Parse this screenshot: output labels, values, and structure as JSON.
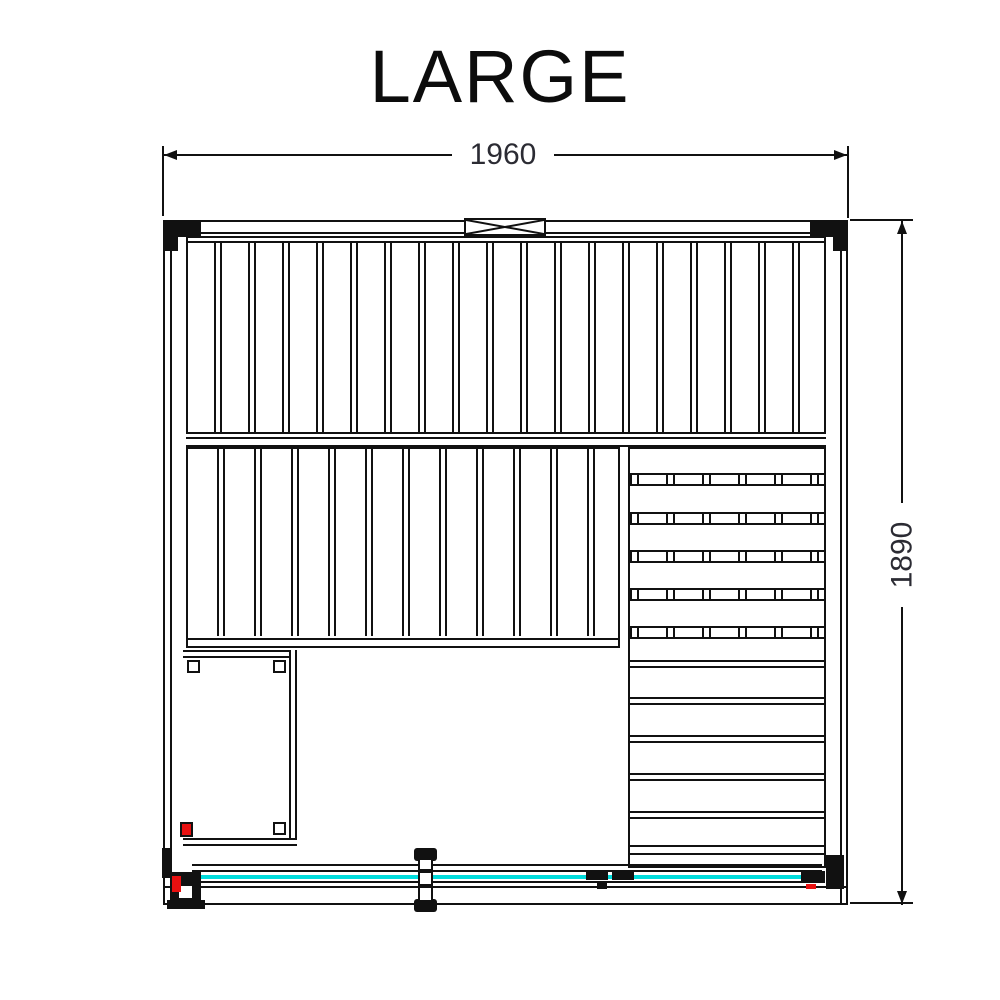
{
  "title": "LARGE",
  "dimensions": {
    "width": "1960",
    "height": "1890"
  },
  "colors": {
    "line": "#111111",
    "dimtext": "#2b2b33",
    "glass": "#00dcdc",
    "accent": "#e81010"
  }
}
